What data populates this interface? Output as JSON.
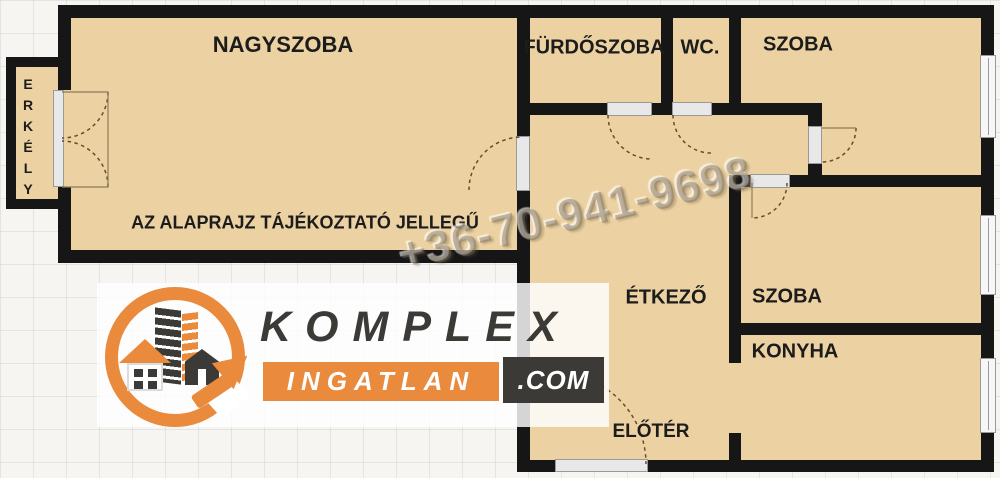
{
  "floorplan": {
    "rooms": [
      {
        "id": "nagyszoba",
        "label": "NAGYSZOBA"
      },
      {
        "id": "erkely",
        "label": "ERKÉLY"
      },
      {
        "id": "furdoszoba",
        "label": "FÜRDŐSZOBA"
      },
      {
        "id": "wc",
        "label": "WC."
      },
      {
        "id": "szoba-felso",
        "label": "SZOBA"
      },
      {
        "id": "etkezo",
        "label": "ÉTKEZŐ"
      },
      {
        "id": "szoba-also",
        "label": "SZOBA"
      },
      {
        "id": "konyha",
        "label": "KONYHA"
      },
      {
        "id": "eloter",
        "label": "ELŐTÉR"
      }
    ],
    "disclaimer": "AZ ALAPRAJZ TÁJÉKOZTATÓ JELLEGŰ"
  },
  "watermark": {
    "phone": "+36-70-941-9698"
  },
  "logo": {
    "brand": "KOMPLEX",
    "product": "INGATLAN",
    "tld": ".COM"
  },
  "colors": {
    "floor": "#ecd2a2",
    "wall": "#161616",
    "label": "#1c1c1c",
    "brand_orange": "#e98a3c",
    "brand_dark": "#3b3a37",
    "door_frame": "#e8e8e8",
    "swing_arc": "#6a4c2a"
  }
}
